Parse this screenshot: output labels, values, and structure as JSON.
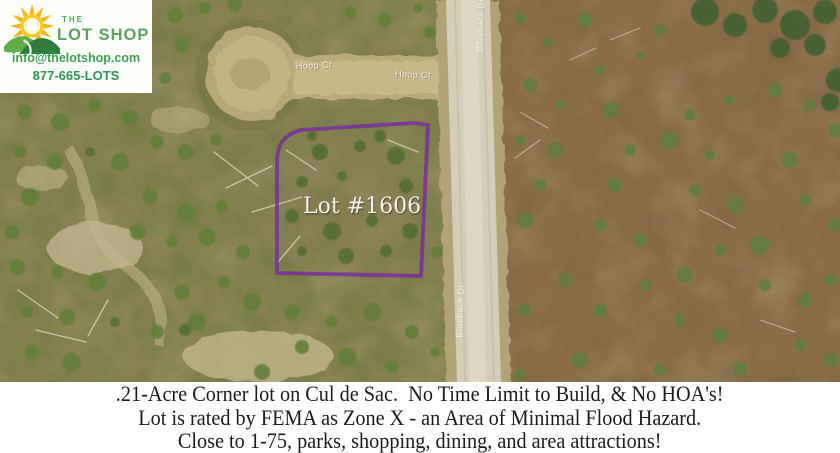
{
  "brand": {
    "the": "THE",
    "name": "LOT SHOP",
    "email": "info@thelotshop.com",
    "phone": "877-665-LOTS",
    "green": "#4aa45c",
    "sun_yellow": "#f2b81a"
  },
  "map": {
    "lot_label": "Lot #1606",
    "hoop_ct_1": "Hoop Ct",
    "hoop_ct_2": "Hoop Ct",
    "road_name_top": "Blueback Dr",
    "road_name_bottom": "Blueback Dr",
    "outline_color": "#8233a1"
  },
  "banner": {
    "line1": ".21-Acre Corner lot on Cul de Sac.  No Time Limit to Build, & No HOA's!",
    "line2": "Lot is rated by FEMA as Zone X - an Area of Minimal Flood Hazard.",
    "line3": "Close to 1-75, parks, shopping, dining, and area attractions!"
  }
}
